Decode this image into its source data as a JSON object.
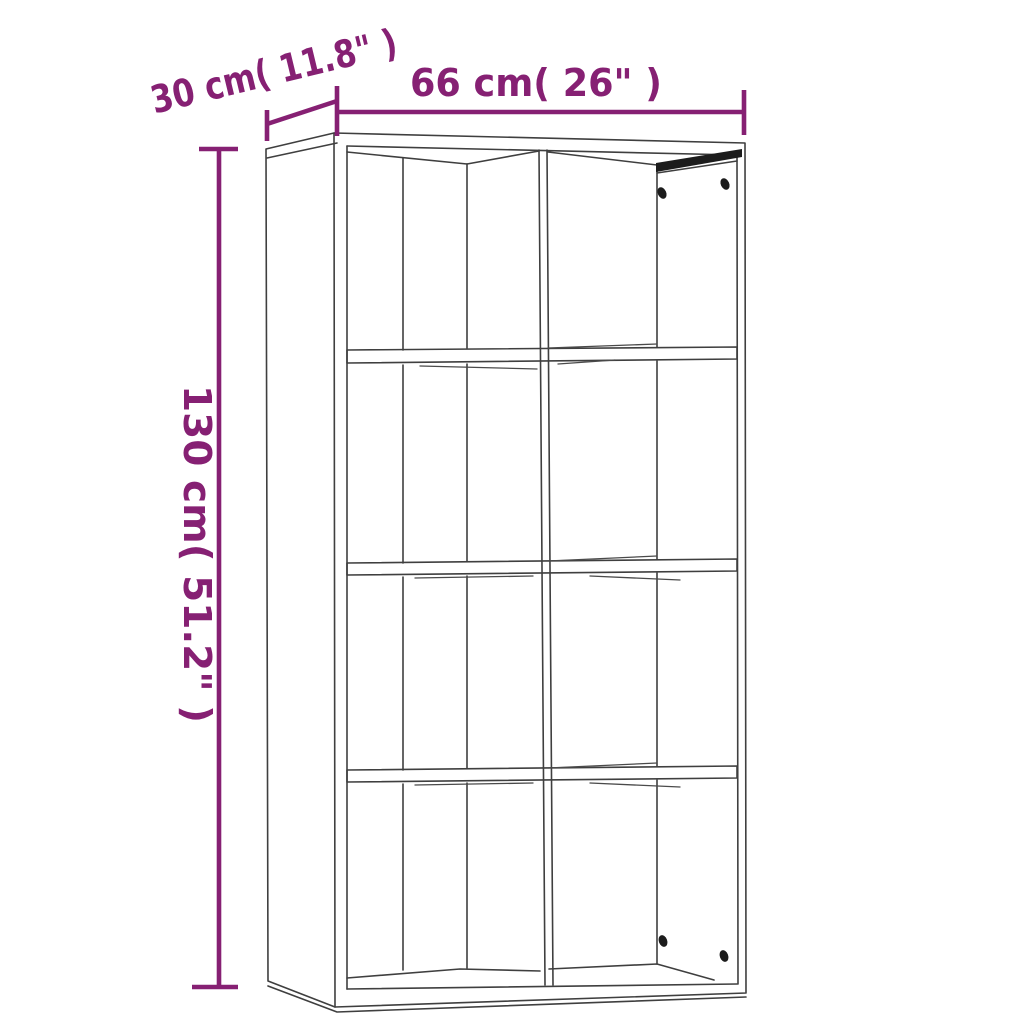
{
  "diagram": {
    "dimensions": {
      "depth_label": "30 cm( 11.8\" )",
      "width_label": "66 cm( 26\" )",
      "height_label": "130 cm( 51.2\" )"
    },
    "colors": {
      "dimension_accent": "#862073",
      "drawing_outline": "#3f3f3f",
      "hardware_dark": "#1c1c1c",
      "background": "#ffffff"
    }
  }
}
